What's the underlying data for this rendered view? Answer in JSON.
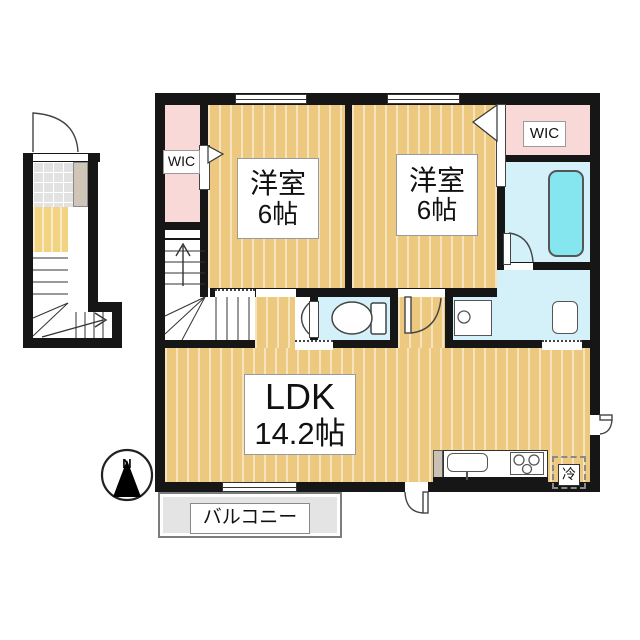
{
  "plan": {
    "type": "apartment-floor-plan-2F",
    "rooms": {
      "bedroom1": {
        "name": "洋室",
        "size": "6帖"
      },
      "bedroom2": {
        "name": "洋室",
        "size": "6帖"
      },
      "ldk": {
        "name": "LDK",
        "size": "14.2帖"
      },
      "wic_left": {
        "name": "WIC"
      },
      "wic_right": {
        "name": "WIC"
      },
      "balcony": {
        "name": "バルコニー"
      }
    },
    "fixtures": {
      "refrigerator": "冷"
    },
    "compass": {
      "north": "N"
    },
    "colors": {
      "wall": "#161616",
      "floor_wood": "#ecc97e",
      "floor_stripe": "#f7e7b9",
      "closet_pink": "#f9d8d8",
      "wet_area_blue": "#d4f0f8",
      "bathtub_cyan": "#85e6f0",
      "balcony_gray": "#e4e4e4",
      "entry_tile_gray": "#e2e2e2",
      "cabinet_beige": "#cfc6b8",
      "hall_yellow": "#f2d382"
    }
  }
}
